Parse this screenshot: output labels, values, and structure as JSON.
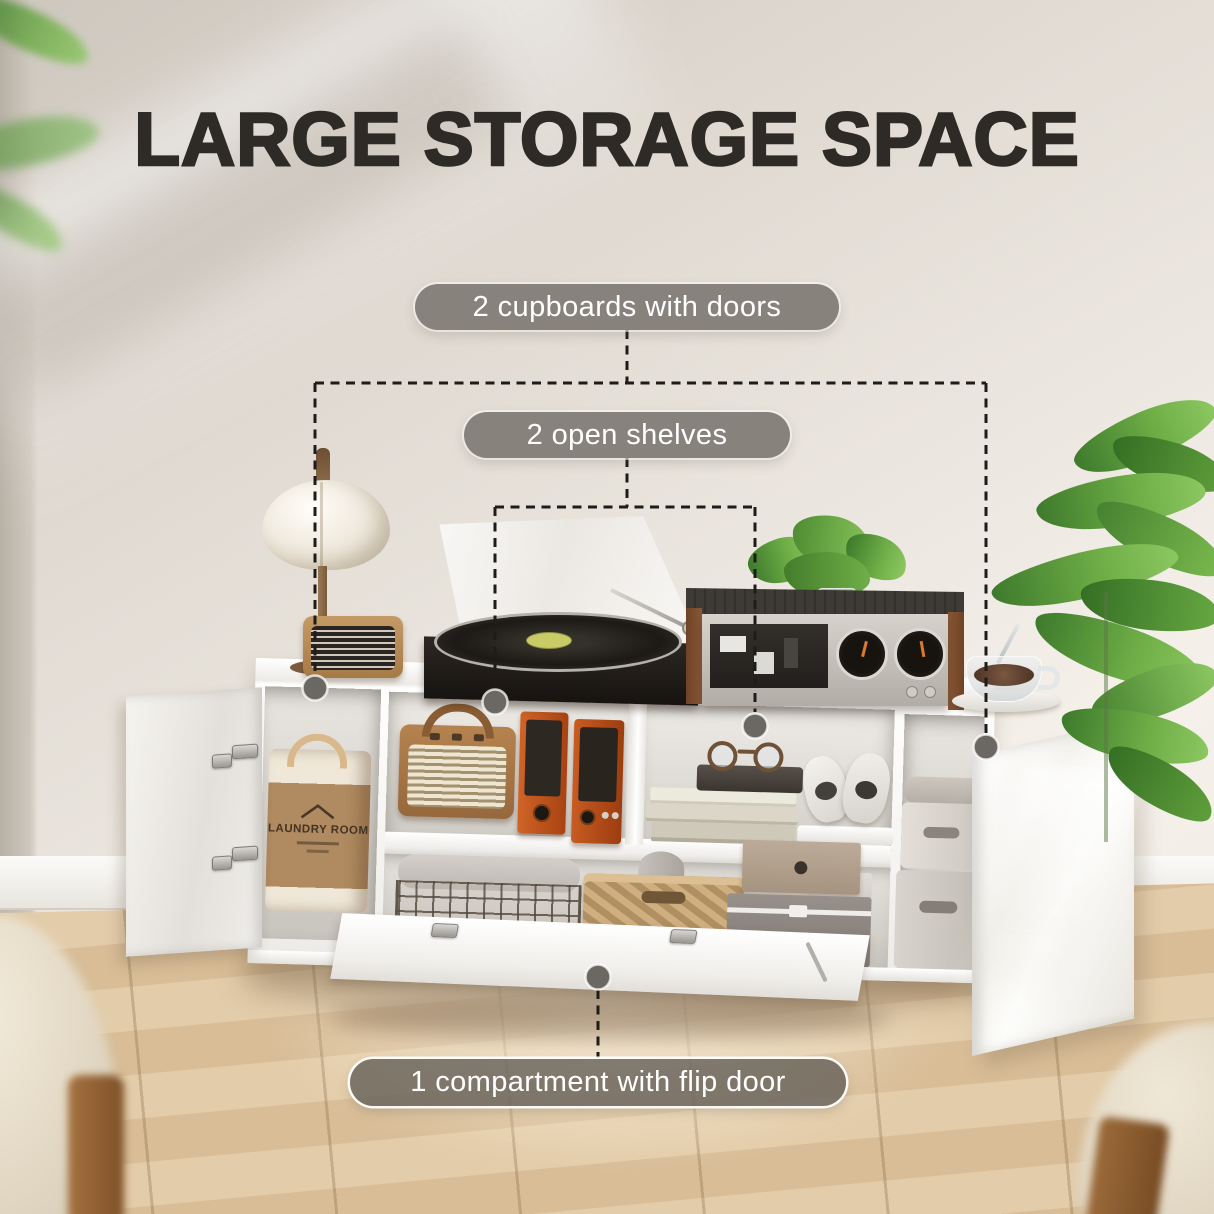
{
  "title": "LARGE STORAGE SPACE",
  "callouts": {
    "cupboards": {
      "label": "2 cupboards with doors"
    },
    "shelves": {
      "label": "2 open shelves"
    },
    "flip": {
      "label": "1 compartment with flip door"
    }
  },
  "scene": {
    "laundry_bag_text": "LAUNDRY ROOM"
  },
  "colors": {
    "title": "#2e2b27",
    "pill_bg": "#87827c",
    "pill_text": "#ffffff",
    "pill_border": "#ffffff",
    "dash_line": "#1d1c1a",
    "dot": "#6b6864",
    "wall": "#e8e2da",
    "floor_wood": "#dcc2a2",
    "cabinet_white": "#fbfaf8",
    "accent_orange": "#c4551f",
    "wood_brown": "#8a5836"
  }
}
